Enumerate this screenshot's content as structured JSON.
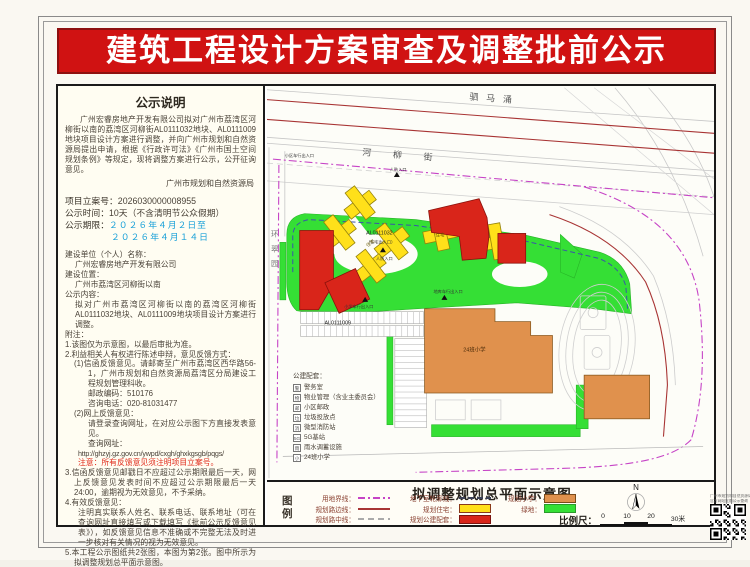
{
  "page": {
    "title": "建筑工程设计方案审查及调整批前公示"
  },
  "notice": {
    "heading": "公示说明",
    "body": "广州宏睿房地产开发有限公司拟对广州市荔湾区河柳街以南的荔湾区河柳街AL0111032地块、AL0111009地块项目设计方案进行调整，并向广州市规划和自然资源局提出申请，根据《行政许可法》《广州市国土空间规划条例》等规定，现将调整方案进行公示，公开征询意见。",
    "authority": "广州市规划和自然资源局",
    "case_label": "项目立案号：",
    "case_number": "2026030000008955",
    "time_label": "公示时间：",
    "time_value": "10天（不含清明节公众假期）",
    "period_label": "公示期限：",
    "period_start": "２０２６年４月２日至",
    "period_end": "２０２６年４月１４日",
    "applicant_label": "建设单位（个人）名称：",
    "applicant": "广州宏睿房地产开发有限公司",
    "location_label": "建设位置：",
    "location": "广州市荔湾区河柳街以南",
    "content_label": "公示内容：",
    "content": "拟对广州市荔湾区河柳街以南的荔湾区河柳街AL0111032地块、AL0111009地块项目设计方案进行调整。",
    "notes_label": "附注：",
    "notes": [
      {
        "text": "1.该图仅为示意图，以最后审批为准。",
        "ind": 0
      },
      {
        "text": "2.利益相关人有权进行陈述申辩，意见反馈方式：",
        "ind": 0
      },
      {
        "text": "(1)信函反馈意见。请邮寄至广州市荔湾区西华路56-1，广州市规划和自然资源局荔湾区分局建设工程规划管理科收。",
        "ind": 1
      },
      {
        "text": "邮政编码：510176",
        "ind": 2
      },
      {
        "text": "咨询电话：020-81031477",
        "ind": 2
      },
      {
        "text": "(2)网上反馈意见：",
        "ind": 1
      },
      {
        "text": "请登录查询网址，在对应公示图下方直接发表意见。",
        "ind": 2
      },
      {
        "text": "查询网址：",
        "ind": 2
      },
      {
        "text": "http://ghzyj.gz.gov.cn/ywpd/cxgh/ghxkgsgb/pqgs/",
        "ind": 3,
        "url": true
      },
      {
        "text": "注意：所有反馈意见须注明项目立案号。",
        "ind": 3,
        "red": true
      },
      {
        "text": "3.信函反馈意见邮戳日不应超过公示期限最后一天，网上反馈意见发表时间不应超过公示期限最后一天24:00，逾期视为无效意见，不予采纳。",
        "ind": 0
      },
      {
        "text": "4.有效反馈意见：",
        "ind": 0
      },
      {
        "text": "注明真实联系人姓名、联系电话、联系地址（可在查询网址直接填写或下载填写《批前公示反馈意见表》），如反馈意见信息不准确或不完整无法及时进一步核对有关情况的视为无效意见。",
        "ind": 3
      },
      {
        "text": "5.本工程公示图纸共2张图，本图为第2张。图中所示为拟调整规划总平面示意图。",
        "ind": 0
      }
    ]
  },
  "map": {
    "canal": "驷马涌",
    "street": "河柳街",
    "road_left_chars": [
      "环",
      "翠",
      "园"
    ],
    "parcel1": "AL0111032",
    "parcel2": "AL0111009",
    "entrance_resident": "（住宅出入口）",
    "entrance_renfang": "人防入口",
    "entrance_district": "小区车行出入口",
    "entrance_school": "小学车行出入口",
    "entrance_garage": "地库车行出入口",
    "label_residence": "住宅",
    "label_school": "24班小学",
    "facilities_title": "公建配套：",
    "facilities": [
      {
        "icon": "警",
        "name": "警务室"
      },
      {
        "icon": "物",
        "name": "物业管理（含业主委员会）"
      },
      {
        "icon": "邮",
        "name": "小区邮政"
      },
      {
        "icon": "垃",
        "name": "垃圾投放点"
      },
      {
        "icon": "消",
        "name": "微型消防站"
      },
      {
        "icon": "5G",
        "name": "5G基站"
      },
      {
        "icon": "雨",
        "name": "雨水调蓄设施"
      },
      {
        "icon": "小",
        "name": "24班小学"
      }
    ]
  },
  "legend": {
    "map_title": "拟调整规划总平面示意图",
    "legend_label_chars": [
      "图",
      "例"
    ],
    "items": [
      {
        "label": "用地界线：",
        "swatch": "line-dashdot-magenta",
        "col": 1
      },
      {
        "label": "规划路边线：",
        "swatch": "line-solid-darkred",
        "col": 1
      },
      {
        "label": "规划路中线：",
        "swatch": "line-dash-gray",
        "col": 1
      },
      {
        "label": "地下室轮廓线：",
        "swatch": "line-dash-dark",
        "col": 2
      },
      {
        "label": "规划住宅：",
        "swatch": "box-yellow",
        "col": 2
      },
      {
        "label": "规划公建配套：",
        "swatch": "box-red",
        "col": 2
      },
      {
        "label": "规划小学：",
        "swatch": "box-orange",
        "col": 3
      },
      {
        "label": "绿地：",
        "swatch": "box-green",
        "col": 3
      }
    ],
    "north": "N",
    "scale_label": "比例尺：",
    "scale_ticks": [
      "0",
      "10",
      "20",
      "30米"
    ]
  },
  "qr": {
    "caption_line1": "广州市规划和自然资源局",
    "caption_line2": "官方网站批前公示查询"
  },
  "colors": {
    "banner_red": "#d01212",
    "residential_yellow": "#ffe01a",
    "public_red": "#d9251a",
    "school_orange": "#e0914d",
    "green_space": "#35df35",
    "site_boundary_magenta": "#c643c6",
    "road_edge_darkred": "#a83434",
    "basement_blue": "#3b55a8",
    "period_blue": "#18a0d8",
    "note_red": "#e02a1a"
  }
}
